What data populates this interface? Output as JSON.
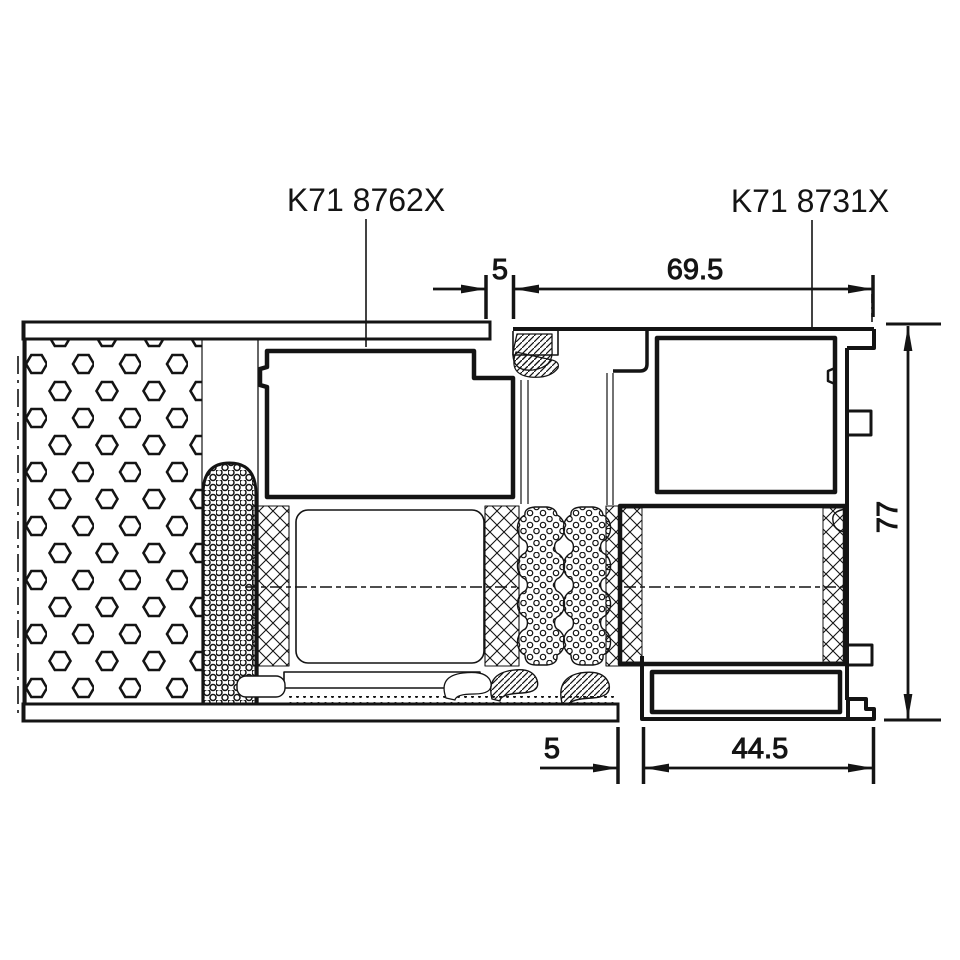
{
  "parts": {
    "left_label": "K71 8762X",
    "right_label": "K71 8731X"
  },
  "dimensions": {
    "top_gap": "5",
    "top_width": "69.5",
    "height": "77",
    "bottom_gap": "5",
    "bottom_width": "44.5"
  },
  "colors": {
    "line": "#141414",
    "background": "#ffffff"
  }
}
